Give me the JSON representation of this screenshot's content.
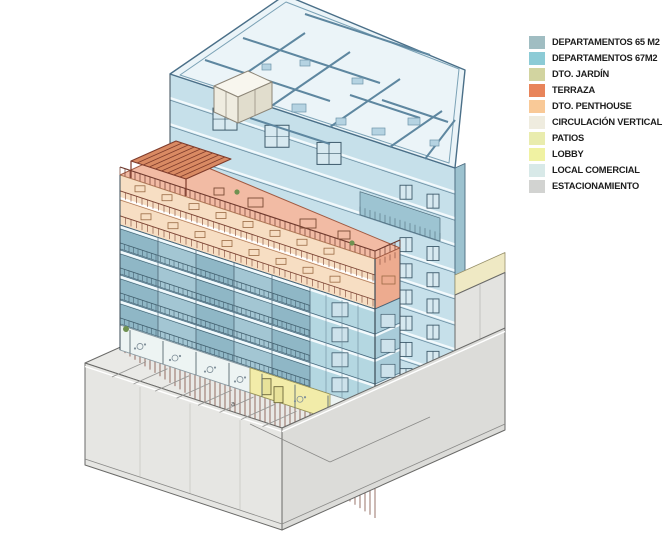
{
  "legend": {
    "items": [
      {
        "label": "DEPARTAMENTOS 65 M2",
        "color": "#a0bdc2"
      },
      {
        "label": "DEPARTAMENTOS 67M2",
        "color": "#8ccbd6"
      },
      {
        "label": "DTO. JARDÍN",
        "color": "#d2d4a0"
      },
      {
        "label": "TERRAZA",
        "color": "#e8845a"
      },
      {
        "label": "DTO. PENTHOUSE",
        "color": "#f9c997"
      },
      {
        "label": "CIRCULACIÓN VERTICAL",
        "color": "#efecdf"
      },
      {
        "label": "PATIOS",
        "color": "#e9ecae"
      },
      {
        "label": "LOBBY",
        "color": "#f0f2a2"
      },
      {
        "label": "LOCAL COMERCIAL",
        "color": "#d8e9e8"
      },
      {
        "label": "ESTACIONAMIENTO",
        "color": "#d2d3d1"
      }
    ]
  },
  "annotations": {
    "deck_label": "a"
  },
  "building_colors": {
    "plan_floor": "#ebf4f8",
    "plan_wall": "#5e87a0",
    "plan_furniture": "#b5d3e2",
    "slab_wall_blue": "#c6e0ea",
    "facade_blue": "#b4d7e1",
    "facade_blue_side": "#a9ccd9",
    "glass_blue_dark": "#8fb7c6",
    "glass_blue_light": "#a3c6d3",
    "window_frame": "#3d5a6b",
    "peach_floor": "#f7dec3",
    "salmon_side": "#edab8f",
    "terrace_deck": "#f2bba4",
    "pergola": "#d98a63",
    "pergola_line": "#7e3b2b",
    "railing_brown": "#7c4434",
    "railing_slate": "#42606f",
    "commercial_white": "#edf4f3",
    "lobby_yellow": "#f2eca9",
    "rear_yellow": "#efe9c4",
    "podium_deck": "#e9e9e6",
    "podium_wall_left": "#e6e6e3",
    "podium_wall_right": "#dcdcd9",
    "podium_line": "#6a6a68",
    "plant_green": "#6f9150",
    "circulation_white": "#f8f6ee"
  }
}
